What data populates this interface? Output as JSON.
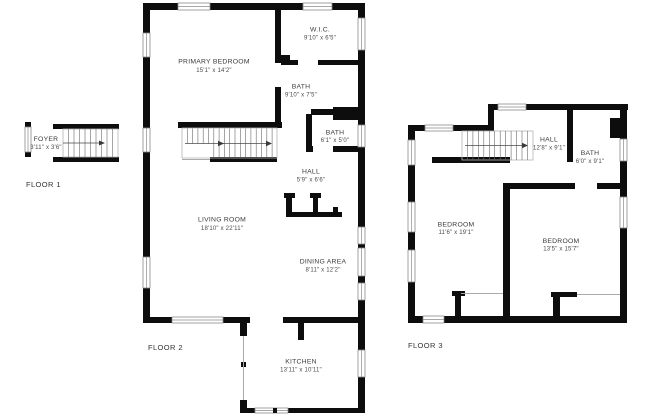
{
  "page": {
    "background_color": "#ffffff",
    "wall_color": "#0d0d0d"
  },
  "floors": [
    {
      "label": "FLOOR 1",
      "rooms": [
        {
          "name": "FOYER",
          "dims": "3'11\" x 3'6\""
        }
      ]
    },
    {
      "label": "FLOOR 2",
      "rooms": [
        {
          "name": "PRIMARY BEDROOM",
          "dims": "15'1\" x 14'2\""
        },
        {
          "name": "W.I.C.",
          "dims": "9'10\" x 6'5\""
        },
        {
          "name": "BATH",
          "dims": "9'10\" x 7'5\""
        },
        {
          "name": "BATH",
          "dims": "6'1\" x 5'0\""
        },
        {
          "name": "HALL",
          "dims": "5'9\" x 6'6\""
        },
        {
          "name": "LIVING ROOM",
          "dims": "18'10\" x 22'11\""
        },
        {
          "name": "DINING AREA",
          "dims": "8'11\" x 12'2\""
        },
        {
          "name": "KITCHEN",
          "dims": "13'11\" x 10'11\""
        }
      ]
    },
    {
      "label": "FLOOR 3",
      "rooms": [
        {
          "name": "HALL",
          "dims": "12'8\" x 9'1\""
        },
        {
          "name": "BATH",
          "dims": "6'0\" x 9'1\""
        },
        {
          "name": "BEDROOM",
          "dims": "11'6\" x 19'1\""
        },
        {
          "name": "BEDROOM",
          "dims": "13'5\" x 15'7\""
        }
      ]
    }
  ]
}
